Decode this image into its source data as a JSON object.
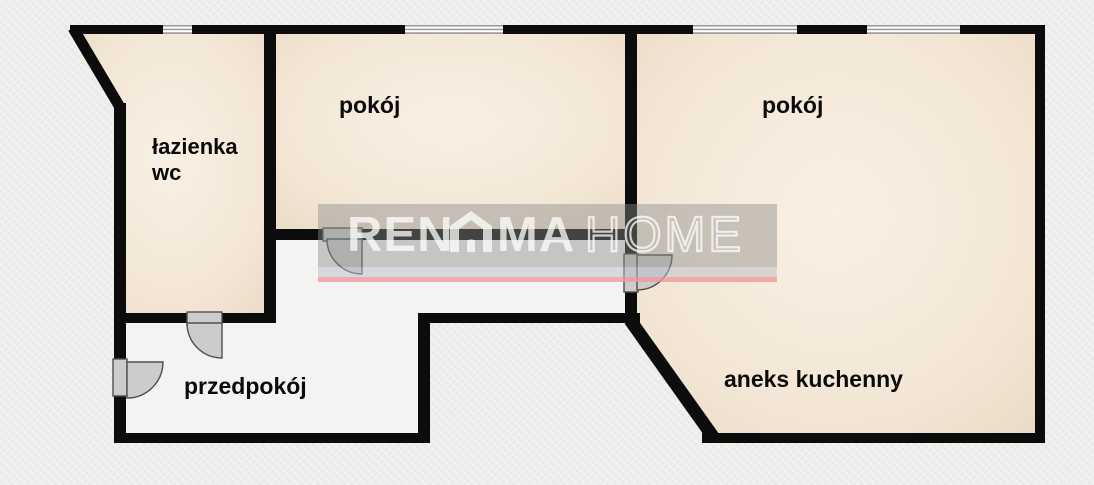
{
  "labels": {
    "bathroom_line1": "łazienka",
    "bathroom_line2": "wc",
    "room1": "pokój",
    "room2": "pokój",
    "hallway": "przedpokój",
    "kitchen": "aneks kuchenny"
  },
  "watermark": {
    "brand_part1": "REN",
    "brand_part2": "MA",
    "brand_part3": "HOME",
    "house_icon": "house-icon"
  },
  "colors": {
    "wall": "#0c0c0c",
    "room_fill": "#f3e6d5",
    "hallway_fill": "#f3f3f1",
    "background": "#eeedeb",
    "window_fill": "#9e9e9e",
    "door_fill": "#cccccc",
    "watermark_pink": "#f0989d",
    "watermark_band": "#8a8a88",
    "label_text": "#0b0b0b"
  }
}
